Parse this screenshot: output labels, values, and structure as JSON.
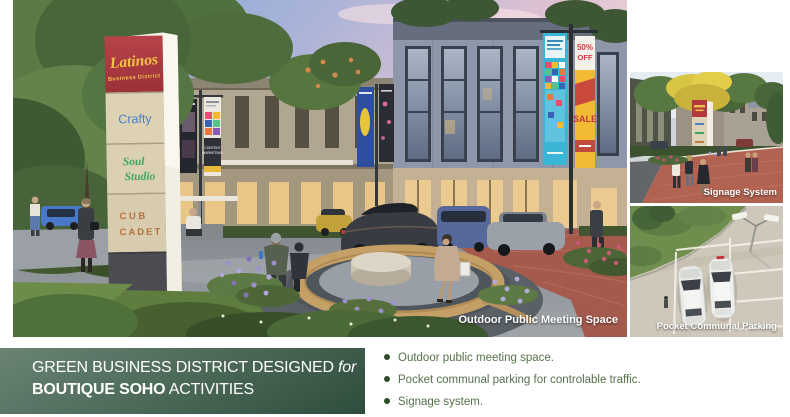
{
  "slide_title": {
    "line1": "GREEN BUSINESS DISTRICT DESIGNED",
    "line1_em": " for",
    "line2_strong": "BOUTIQUE SOHO",
    "line2": " ACTIVITIES"
  },
  "key_points": [
    "Outdoor public meeting space.",
    "Pocket communal parking for controlable traffic.",
    "Signage system."
  ],
  "main_image": {
    "caption": "Outdoor Public Meeting Space",
    "pylon": {
      "brand": "Latinos",
      "brand_sub": "Business District",
      "tenant_1": "Crafty",
      "tenant_2a": "Soul",
      "tenant_2b": "Studio",
      "tenant_3a": "CUB",
      "tenant_3b": "CADET"
    },
    "banner": {
      "promo_pct": "50%",
      "promo_off": "OFF",
      "promo_sale": "SALE",
      "content_1": "CONTENT",
      "content_2": "MARKETING"
    }
  },
  "side_images": {
    "signage": {
      "caption": "Signage System"
    },
    "parking": {
      "caption": "Pocket Communal Parking"
    }
  },
  "colors": {
    "title_bar_top": "#6a8374",
    "title_bar_bottom": "#2f4d3c",
    "bullet_text": "#54724a",
    "bullet_dot": "#2d4a2b",
    "caption_text": "#ffffff",
    "pylon_red": "#b03d44",
    "pylon_beige": "#ddd2b4",
    "brand_yellow": "#f2c34b",
    "tenant_blue": "#4a7fc1",
    "tenant_green": "#3ea767",
    "tenant_orange": "#b5713f"
  }
}
